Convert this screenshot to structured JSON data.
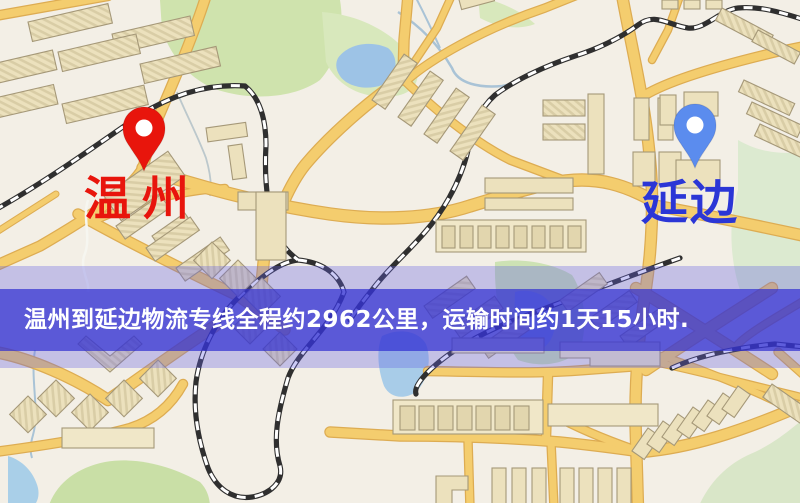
{
  "map": {
    "origin": {
      "label": "温州",
      "label_color": "#e8150c",
      "pin_color": "#e8150c"
    },
    "destination": {
      "label": "延边",
      "label_color": "#2b36d6",
      "pin_color": "#5b8cee"
    }
  },
  "banner": {
    "text": "温州到延边物流专线全程约2962公里，运输时间约1天15小时.",
    "text_color": "#ffffff",
    "bg_color": "#2f2ed2"
  },
  "palette": {
    "map_background": "#f3efe6",
    "road_fill": "#f4cd6e",
    "road_casing": "#ddac52",
    "building_fill": "#ece1bd",
    "park_green": "#cfe3ad",
    "water_blue": "#9dc3e6",
    "railway_dark": "#2f2f2f",
    "pin_hole_white": "#ffffff"
  }
}
